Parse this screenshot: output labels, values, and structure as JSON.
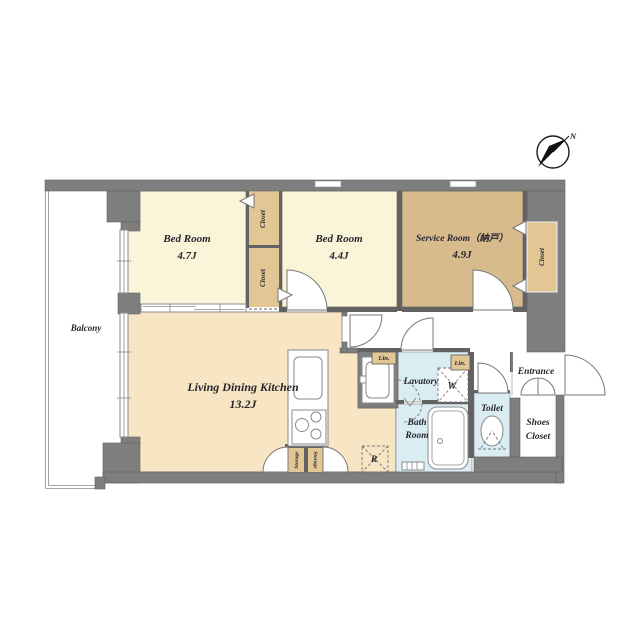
{
  "colors": {
    "wall": "#7e7e7e",
    "wall_dark": "#626262",
    "bedroom": "#faf5d9",
    "service": "#d7bb8d",
    "closet": "#e2c795",
    "ldk": "#f7e5c3",
    "wet": "#d9edf2",
    "paper": "#ffffff",
    "ink": "#26262e"
  },
  "compass": {
    "label": "N"
  },
  "rooms": {
    "balcony": {
      "label": "Balcony"
    },
    "bedroom1": {
      "label": "Bed Room",
      "size": "4.7J"
    },
    "bedroom2": {
      "label": "Bed Room",
      "size": "4.4J"
    },
    "service": {
      "label": "Service Room（納戸）",
      "size": "4.9J"
    },
    "ldk": {
      "label": "Living Dining Kitchen",
      "size": "13.2J"
    },
    "lavatory": {
      "label": "Lavatory"
    },
    "bath": {
      "line1": "Bath",
      "line2": "Room"
    },
    "toilet": {
      "label": "Toilet"
    },
    "entrance": {
      "label": "Entrance"
    },
    "shoes_closet": {
      "line1": "Shoes",
      "line2": "Closet"
    }
  },
  "storage": {
    "closet_a": "Closet",
    "closet_b": "Closet",
    "closet_c": "Closet",
    "storage_left": "Storage",
    "storage_right": "Storage",
    "linen_left": "Lin.",
    "linen_right": "Lin."
  },
  "appliance_marks": {
    "washer": "W",
    "fridge": "R"
  }
}
